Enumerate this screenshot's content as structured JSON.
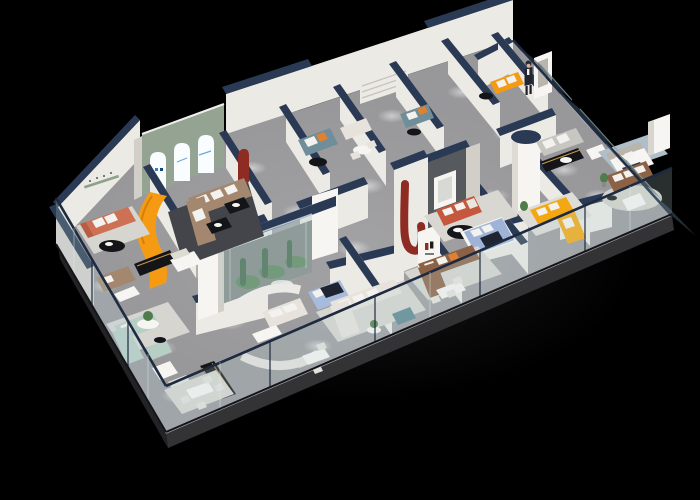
{
  "scene": {
    "kind": "3d-isometric-showroom-render",
    "description": "Cutaway 3D floor plan render of a furniture showroom at night on a black background",
    "rows_of_rooms": 2,
    "visible_text": "none-legible"
  },
  "palette": {
    "bg": "#000000",
    "floor": "#98989b",
    "floorLight": "#b3b3b5",
    "slabSide": "#232326",
    "slabFront": "#333336",
    "wallFace": "#eceae5",
    "wallSide": "#d2cfc9",
    "wallShadow": "#b3b0aa",
    "navyCap": "#2b3a54",
    "railNavy": "#1d2a40",
    "glass": "#b9d6d8",
    "glassDark": "#3c4e58",
    "glassEdge": "#dff0f2",
    "sage": "#95a392",
    "archWhite": "#fafdff",
    "logoBlue": "#2f7fd0",
    "orange": "#f59b13",
    "coral": "#cd7054",
    "taupe": "#a3886f",
    "tealSofa": "#6f8e99",
    "mint": "#b7cec5",
    "cream": "#e7e3dc",
    "yellow": "#f2a713",
    "brown": "#8c6247",
    "redSofa": "#c4573d",
    "graySofa": "#c7c6c0",
    "blueBed": "#a7bcdc",
    "periwinkle": "#9fb2d8",
    "charcoal": "#56595d",
    "redArt": "#8e2c24",
    "black": "#141518",
    "gold": "#c9993f",
    "white": "#f6f5f2",
    "rugDark": "#43454a",
    "rugLight": "#d6d5d0",
    "rugBlue": "#aebfca",
    "plant": "#4f7c4b",
    "plantDark": "#355c3a",
    "skin": "#d9b295"
  },
  "objects": {
    "floor": "showroom floor slab",
    "backWalls": "white perimeter walls with navy caps",
    "arches": "sage wall with three backlit arched niches",
    "aquarium": "glass planter display box with cacti and pebbles",
    "charcoalWall": "charcoal media feature wall with white art frame",
    "cylinder": "white cylindrical column with navy top",
    "redJ": "dark red curved sculpture wall",
    "logoPillar": "white pillar with small red brand logo",
    "orangeSlide": "orange curved display ribbon",
    "suite": "curved white partition suite with blue bed",
    "rightFacade": "tinted glass curtain-wall panels",
    "balustrade": "transparent glass balustrade with navy handrail",
    "staff": "standing staff figure beside display board",
    "sofas": "coral, taupe, teal, mint, cream, yellow, brown, red-orange and gray sofa vignettes",
    "spotlights": "ceiling spotlight pools on the floor"
  }
}
